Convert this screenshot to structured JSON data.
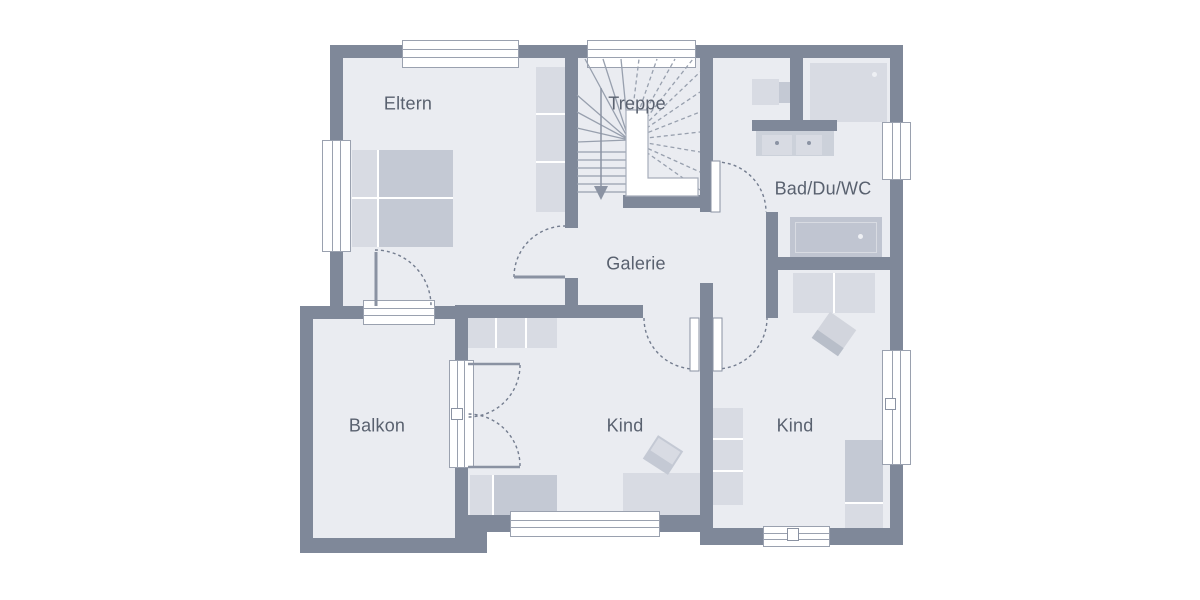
{
  "floorplan": {
    "title": "Obergeschoss Grundriss",
    "rooms": [
      {
        "id": "eltern",
        "label": "Eltern"
      },
      {
        "id": "treppe",
        "label": "Treppe"
      },
      {
        "id": "bad",
        "label": "Bad/Du/WC"
      },
      {
        "id": "galerie",
        "label": "Galerie"
      },
      {
        "id": "kind-1",
        "label": "Kind"
      },
      {
        "id": "kind-2",
        "label": "Kind"
      },
      {
        "id": "balkon",
        "label": "Balkon"
      }
    ],
    "colors": {
      "wall": "#7f8899",
      "room_fill": "#eaecf1",
      "furniture_light": "#d8dbe3",
      "furniture_medium": "#c4c9d4",
      "label_text": "#59616f",
      "stair_line": "#98a0ae",
      "door_arc": "#747d8f",
      "background": "#ffffff"
    }
  }
}
